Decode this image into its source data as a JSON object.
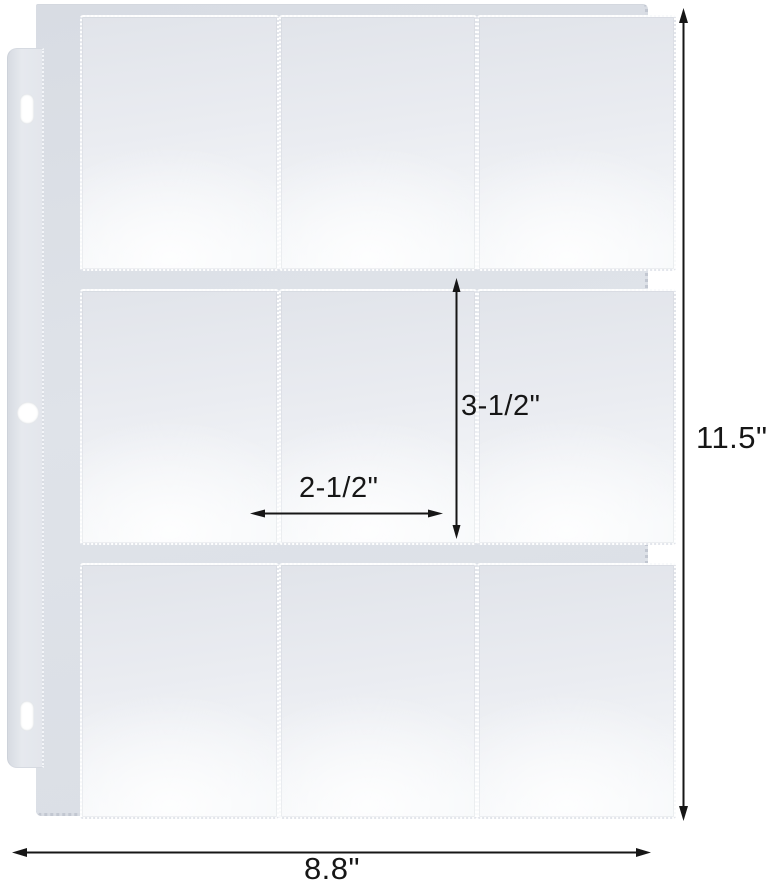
{
  "product": {
    "name": "nine-pocket trading card page",
    "rows": 3,
    "cols": 3,
    "binder_holes": 3
  },
  "annotations": {
    "page_height": "11.5\"",
    "page_width": "8.8\"",
    "pocket_height": "3-1/2\"",
    "pocket_width": "2-1/2\""
  },
  "colors": {
    "background": "#ffffff",
    "sheet_base": "#dcdfe6",
    "pocket_light": "#f6f8fa",
    "pocket_dark": "#e1e4ea",
    "edge_dots": "#c2c7d1",
    "annotation_ink": "#161616"
  }
}
